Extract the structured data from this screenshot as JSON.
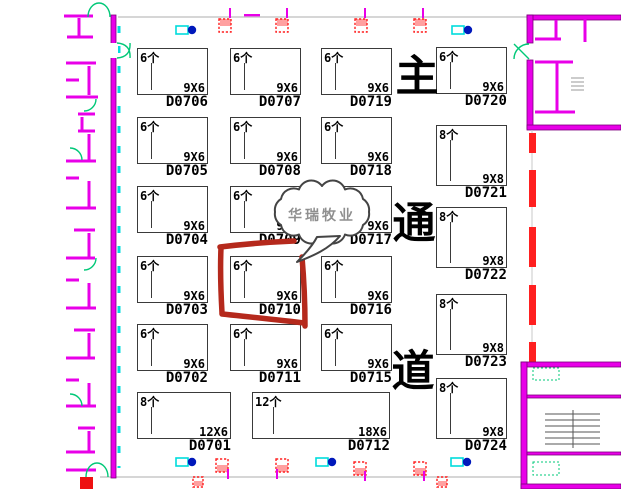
{
  "title": "展位平面图 (booth floor plan)",
  "colors": {
    "wall_magenta": "#e800e8",
    "door_green": "#00c878",
    "guide_cyan": "#00dcdc",
    "marker_blue": "#0018bb",
    "alarm_red": "#ff2020",
    "highlight_red": "#b5291c",
    "callout_gray": "#8f8f8f",
    "booth_line": "#3a3a3a"
  },
  "aisle_label": {
    "chars": [
      "主",
      "通",
      "道"
    ]
  },
  "callout": {
    "text": "华瑞牧业",
    "points_to": "D0710"
  },
  "highlighted_booth": "D0710",
  "booths": [
    {
      "id": "D0706",
      "count": "6个",
      "size": "9X6",
      "x": 137,
      "y": 48,
      "w": 71,
      "h": 47
    },
    {
      "id": "D0707",
      "count": "6个",
      "size": "9X6",
      "x": 230,
      "y": 48,
      "w": 71,
      "h": 47
    },
    {
      "id": "D0719",
      "count": "6个",
      "size": "9X6",
      "x": 321,
      "y": 48,
      "w": 71,
      "h": 47
    },
    {
      "id": "D0720",
      "count": "6个",
      "size": "9X6",
      "x": 436,
      "y": 47,
      "w": 71,
      "h": 47
    },
    {
      "id": "D0705",
      "count": "6个",
      "size": "9X6",
      "x": 137,
      "y": 117,
      "w": 71,
      "h": 47
    },
    {
      "id": "D0708",
      "count": "6个",
      "size": "9X6",
      "x": 230,
      "y": 117,
      "w": 71,
      "h": 47
    },
    {
      "id": "D0718",
      "count": "6个",
      "size": "9X6",
      "x": 321,
      "y": 117,
      "w": 71,
      "h": 47
    },
    {
      "id": "D0721",
      "count": "8个",
      "size": "9X8",
      "x": 436,
      "y": 125,
      "w": 71,
      "h": 61
    },
    {
      "id": "D0704",
      "count": "6个",
      "size": "9X6",
      "x": 137,
      "y": 186,
      "w": 71,
      "h": 47
    },
    {
      "id": "D0709",
      "count": "6个",
      "size": "9X6",
      "x": 230,
      "y": 186,
      "w": 71,
      "h": 47
    },
    {
      "id": "D0717",
      "count": "6个",
      "size": "9X6",
      "x": 321,
      "y": 186,
      "w": 71,
      "h": 47
    },
    {
      "id": "D0722",
      "count": "8个",
      "size": "9X8",
      "x": 436,
      "y": 207,
      "w": 71,
      "h": 61
    },
    {
      "id": "D0703",
      "count": "6个",
      "size": "9X6",
      "x": 137,
      "y": 256,
      "w": 71,
      "h": 47
    },
    {
      "id": "D0710",
      "count": "6个",
      "size": "9X6",
      "x": 230,
      "y": 256,
      "w": 71,
      "h": 47
    },
    {
      "id": "D0716",
      "count": "6个",
      "size": "9X6",
      "x": 321,
      "y": 256,
      "w": 71,
      "h": 47
    },
    {
      "id": "D0723",
      "count": "8个",
      "size": "9X8",
      "x": 436,
      "y": 294,
      "w": 71,
      "h": 61
    },
    {
      "id": "D0702",
      "count": "6个",
      "size": "9X6",
      "x": 137,
      "y": 324,
      "w": 71,
      "h": 47
    },
    {
      "id": "D0711",
      "count": "6个",
      "size": "9X6",
      "x": 230,
      "y": 324,
      "w": 71,
      "h": 47
    },
    {
      "id": "D0715",
      "count": "6个",
      "size": "9X6",
      "x": 321,
      "y": 324,
      "w": 71,
      "h": 47
    },
    {
      "id": "D0724",
      "count": "8个",
      "size": "9X8",
      "x": 436,
      "y": 378,
      "w": 71,
      "h": 61
    },
    {
      "id": "D0701",
      "count": "8个",
      "size": "12X6",
      "x": 137,
      "y": 392,
      "w": 94,
      "h": 47
    },
    {
      "id": "D0712",
      "count": "12个",
      "size": "18X6",
      "x": 252,
      "y": 392,
      "w": 138,
      "h": 47
    }
  ]
}
